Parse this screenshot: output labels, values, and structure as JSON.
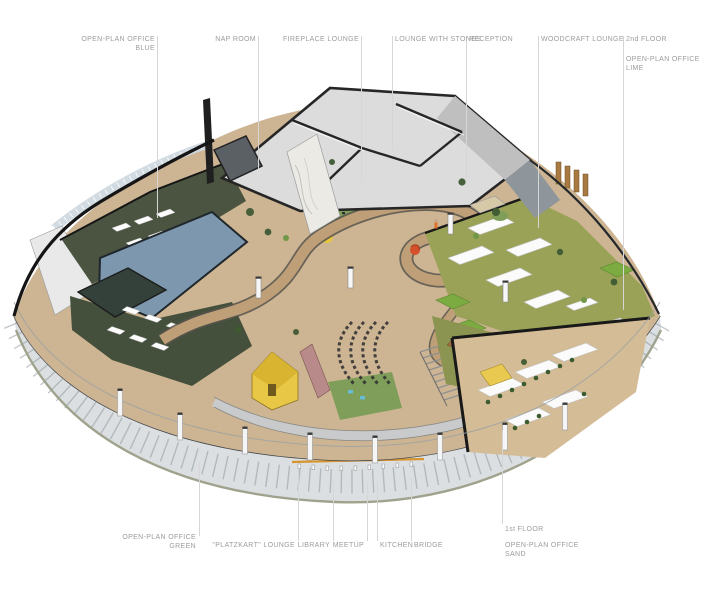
{
  "callouts": {
    "top": [
      {
        "text1": "OPEN-PLAN OFFICE",
        "text2": "BLUE"
      },
      {
        "text1": "NAP ROOM"
      },
      {
        "text1": "FIREPLACE LOUNGE"
      },
      {
        "text1": "LOUNGE WITH STONES"
      },
      {
        "text1": "RECEPTION"
      },
      {
        "text1": "WOODCRAFT LOUNGE"
      },
      {
        "text1": "2nd FLOOR"
      },
      {
        "text1": "OPEN-PLAN OFFICE",
        "text2": "LIME"
      }
    ],
    "bottom": [
      {
        "text1": "OPEN-PLAN OFFICE",
        "text2": "GREEN"
      },
      {
        "text1": "\"PLATZKART\" LOUNGE"
      },
      {
        "text1": "LIBRARY"
      },
      {
        "text1": "MEETUP"
      },
      {
        "text1": "KITCHEN"
      },
      {
        "text1": "BRIDGE"
      },
      {
        "text1": "1st FLOOR"
      },
      {
        "text1": "OPEN-PLAN OFFICE",
        "text2": "SAND"
      }
    ]
  },
  "palette": {
    "label_text": "#9C9C9C",
    "leader_line": "#D6D6D6",
    "outline_black": "#1A1A1A",
    "roof_gray": "#DCDCDC",
    "wood_floor": "#CDB593",
    "ramp_wood": "#BF9F77",
    "lawn_green": "#7F9E5A",
    "dark_green_floor": "#42503C",
    "olive_floor": "#99A257",
    "sand_floor": "#D4BC96",
    "blue_roof": "#7D98AE",
    "partition_green": "#7CAB41",
    "accent_yellow": "#E8C646",
    "accent_red": "#D5512C",
    "glass_band": "#DBDFE1"
  }
}
